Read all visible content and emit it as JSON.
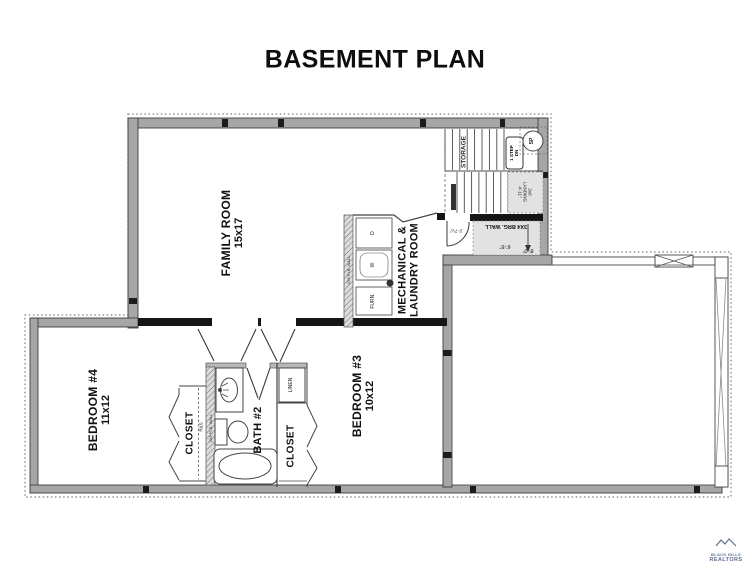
{
  "title": "BASEMENT PLAN",
  "rooms": {
    "family_room": {
      "name": "FAMILY ROOM",
      "dims": "15x17"
    },
    "mechanical": {
      "line1": "MECHANICAL &",
      "line2": "LAUNDRY ROOM"
    },
    "bedroom4": {
      "name": "BEDROOM #4",
      "dims": "11x12"
    },
    "bedroom3": {
      "name": "BEDROOM #3",
      "dims": "10x12"
    },
    "bath2": {
      "name": "BATH #2"
    },
    "closet_bed4": {
      "name": "CLOSET"
    },
    "closet_bed3": {
      "name": "CLOSET"
    },
    "linen": {
      "name": "LINEN"
    },
    "storage": {
      "name": "STORAGE"
    }
  },
  "stairs": {
    "one_step": "1 STEP",
    "dn": "DN",
    "sump_pump": "SP",
    "landing_l1": "2x6",
    "landing_l2": "LANDING",
    "landing_l3": "4'-11\""
  },
  "annotations": {
    "bearing_wall": "3X4 BRG. WALL",
    "plumbing_wall": "2X6 PLB. WALL",
    "rod_shelf": "R&S",
    "door_dim": "2'-7¼\"",
    "dim_a": "6'-5\"",
    "dim_b": "8'-0\"",
    "dryer": "D",
    "washer": "W",
    "furnace": "FURN."
  },
  "logo": {
    "line1": "BLACK HILLS",
    "line2": "REALTORS"
  },
  "colors": {
    "wall_gray": "#a6a6a6",
    "wall_edge": "#3f3f3f",
    "black_wall": "#151515",
    "line_dark": "#444444",
    "light_fill": "#e2e2e2",
    "dotted": "#7d7d7d",
    "logo_blue": "#5d6f92",
    "text": "#111111"
  }
}
